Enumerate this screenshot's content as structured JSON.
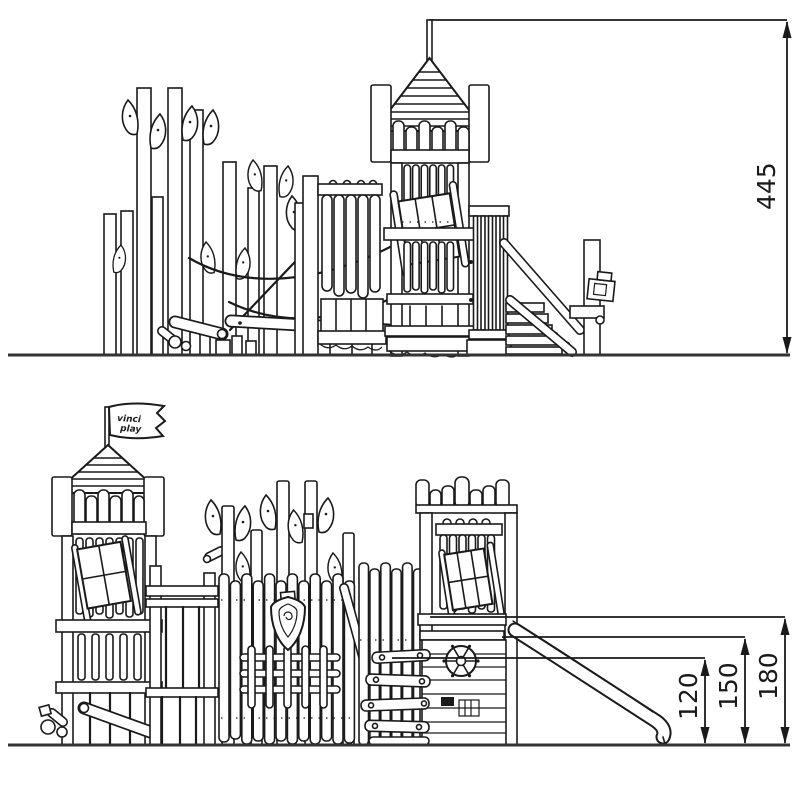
{
  "drawing": {
    "background": "#ffffff",
    "line_color": "#1a1a1a",
    "side_view": {
      "height_dimension": "445"
    },
    "front_view": {
      "flag": {
        "line1": "vinci",
        "line2": "play"
      },
      "dimensions": {
        "slide_height": "120",
        "mid_height": "150",
        "deck_height": "180"
      }
    }
  }
}
